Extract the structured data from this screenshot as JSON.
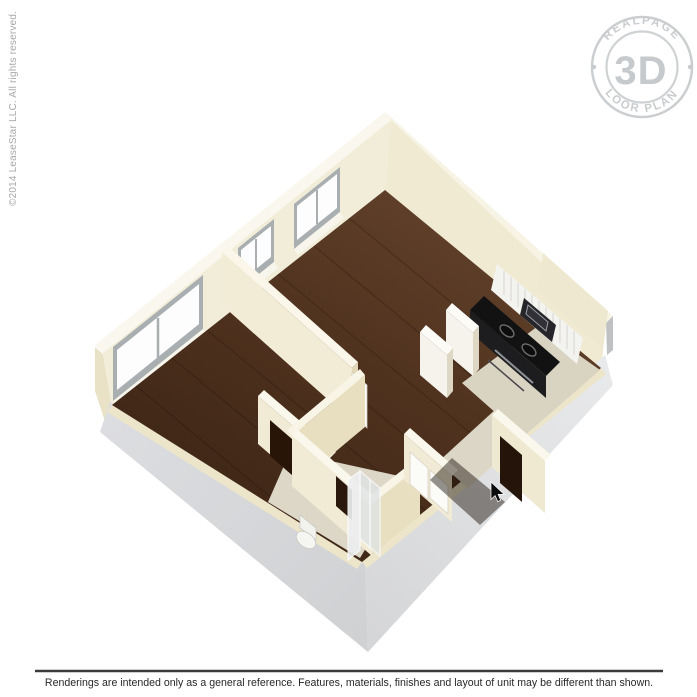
{
  "watermark": {
    "arc_top": "REALPAGE",
    "center": "3D",
    "arc_bottom": "FLOOR PLANS"
  },
  "copyright": "©2014 LeaseStar LLC. All rights reserved.",
  "disclaimer": "Renderings are intended only as a general reference. Features, materials, finishes and layout of unit may be different than shown.",
  "colors": {
    "wood_floor": "#4e3220",
    "wall_cream": "#f2ecd6",
    "wall_top": "#faf8ee",
    "slab_gray": "#d8d9db",
    "tile": "#d9d3c3",
    "appliance_black": "#141414",
    "watermark_gray": "#c6c9cb",
    "disclaimer_text": "#282828",
    "copyright_text": "#a8a8a8"
  }
}
